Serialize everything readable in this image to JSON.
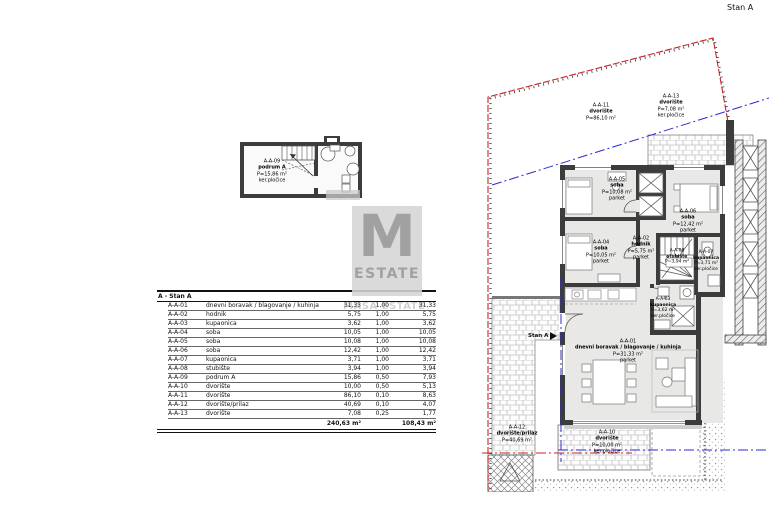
{
  "page": {
    "top_right_label": "Stan A"
  },
  "watermark": {
    "letter": "M",
    "brand": "ESTATE",
    "faint": "MASA ESTATE"
  },
  "colors": {
    "boundary_red": "#cc2222",
    "parcel_blue": "#2b2bd6",
    "wall_dark": "#3c3c3c",
    "room_grey": "#e8e8e6"
  },
  "table": {
    "title": "A - Stan A",
    "rows": [
      {
        "code": "A-A-01",
        "name": "dnevni boravak / blagovanje / kuhinja",
        "area": "31,33",
        "coef": "1,00",
        "net": "31,33"
      },
      {
        "code": "A-A-02",
        "name": "hodnik",
        "area": "5,75",
        "coef": "1,00",
        "net": "5,75"
      },
      {
        "code": "A-A-03",
        "name": "kupaonica",
        "area": "3,62",
        "coef": "1,00",
        "net": "3,62"
      },
      {
        "code": "A-A-04",
        "name": "soba",
        "area": "10,05",
        "coef": "1,00",
        "net": "10,05"
      },
      {
        "code": "A-A-05",
        "name": "soba",
        "area": "10,08",
        "coef": "1,00",
        "net": "10,08"
      },
      {
        "code": "A-A-06",
        "name": "soba",
        "area": "12,42",
        "coef": "1,00",
        "net": "12,42"
      },
      {
        "code": "A-A-07",
        "name": "kupaonica",
        "area": "3,71",
        "coef": "1,00",
        "net": "3,71"
      },
      {
        "code": "A-A-08",
        "name": "stubište",
        "area": "3,94",
        "coef": "1,00",
        "net": "3,94"
      },
      {
        "code": "A-A-09",
        "name": "podrum A",
        "area": "15,86",
        "coef": "0,50",
        "net": "7,93"
      },
      {
        "code": "A-A-10",
        "name": "dvorište",
        "area": "10,00",
        "coef": "0,50",
        "net": "5,13"
      },
      {
        "code": "A-A-11",
        "name": "dvorište",
        "area": "86,10",
        "coef": "0,10",
        "net": "8,63"
      },
      {
        "code": "A-A-12",
        "name": "dvorište/prilaz",
        "area": "40,69",
        "coef": "0,10",
        "net": "4,07"
      },
      {
        "code": "A-A-13",
        "name": "dvorište",
        "area": "7,08",
        "coef": "0,25",
        "net": "1,77"
      }
    ],
    "total_area": "240,63 m²",
    "total_net": "108,43 m²"
  },
  "plan_labels": {
    "aa09": {
      "code": "A-A-09",
      "name": "podrum A",
      "area": "P=15,86 m²",
      "floor": "ker.pločice"
    },
    "aa11": {
      "code": "A-A-11",
      "name": "dvorište",
      "area": "P=86,10 m²"
    },
    "aa13": {
      "code": "A-A-13",
      "name": "dvorište",
      "area": "P=7,08 m²",
      "floor": "ker.pločice"
    },
    "aa05": {
      "code": "A-A-05",
      "name": "soba",
      "area": "P=10,08 m²",
      "floor": "parket"
    },
    "aa06": {
      "code": "A-A-06",
      "name": "soba",
      "area": "P=12,42 m²",
      "floor": "parket"
    },
    "aa04": {
      "code": "A-A-04",
      "name": "soba",
      "area": "P=10,05 m²",
      "floor": "parket"
    },
    "aa02": {
      "code": "A-A-02",
      "name": "hodnik",
      "area": "P=5,75 m²",
      "floor": "parket"
    },
    "aa08": {
      "code": "A-A-08",
      "name": "stubište",
      "area": "P=3,94 m²"
    },
    "aa07": {
      "code": "A-A-07",
      "name": "kupaonica",
      "area": "P=3,71 m²",
      "floor": "ker.pločice"
    },
    "aa03": {
      "code": "A-A-03",
      "name": "kupaonica",
      "area": "P=3,62 m²",
      "floor": "ker.pločice"
    },
    "aa01": {
      "code": "A-A-01",
      "name": "dnevni boravak / blagovanje / kuhinja",
      "area": "P=31,33 m²",
      "floor": "parket"
    },
    "aa12": {
      "code": "A-A-12",
      "name": "dvorište/prilaz",
      "area": "P=40,69 m²"
    },
    "aa10": {
      "code": "A-A-10",
      "name": "dvorište",
      "area": "P=10,00 m²",
      "floor": "ker.pločice"
    },
    "entrance": {
      "label": "Stan A"
    }
  }
}
